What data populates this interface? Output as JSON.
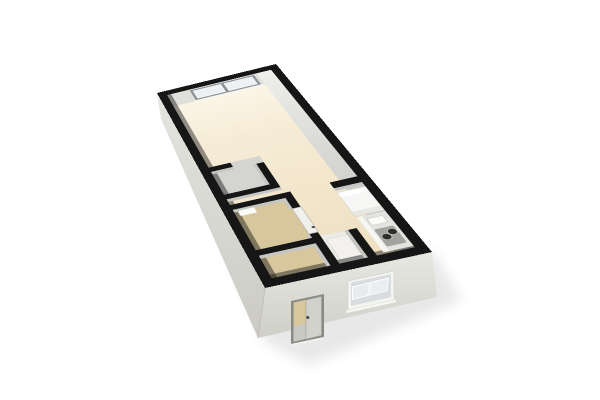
{
  "scene": {
    "type": "3d-floor-plan-render",
    "description": "Isometric 3D rendering of a narrow studio apartment floor plan on a white background, viewed from above at an angle",
    "rooms": [
      {
        "name": "living-area",
        "floor_finish": "cream"
      },
      {
        "name": "closet",
        "floor_finish": "gray"
      },
      {
        "name": "bathroom",
        "floor_finish": "tan"
      },
      {
        "name": "entry-hall",
        "floor_finish": "tan"
      },
      {
        "name": "storage-niche",
        "floor_finish": "white"
      },
      {
        "name": "kitchen-nook",
        "floor_finish": "cream"
      }
    ],
    "fixtures": [
      "double-pane-window-far-wall",
      "entry-door-near-wall",
      "tilted-sash-kitchen-window-near-wall",
      "bathroom-door",
      "bathroom-sink",
      "kitchen-partition-wall",
      "refrigerator",
      "kitchen-counter",
      "kitchen-sink",
      "cooktop"
    ],
    "cooktop_burner_count": 2,
    "far_window_pane_count": 2,
    "kitchen_window_sash_count": 2
  },
  "palette": {
    "background": "#ffffff",
    "wall_top": "#161616",
    "wall_interior_face": "#dfdfdc",
    "wall_interior_dark": "#c6c6c2",
    "exterior_sw_face": "#d9d9d3",
    "exterior_se_face": "#dedcd5",
    "floor_main": "#f2e4c8",
    "floor_entry": "#d8c69d",
    "floor_bath": "#d8c69c",
    "floor_closet": "#d4d4d0",
    "glass": "#e9edf0",
    "frame_gray": "#8f9499",
    "frame_white": "#f4f4f0",
    "door_white": "#f0f0ed",
    "door_frame": "#8a8a85",
    "door_panel": "#d2d2cd",
    "appliance_white": "#f7f7f5",
    "counter": "#e3e3df",
    "cooktop_panel": "#a3a39f",
    "burner": "#2d2d2b",
    "handle": "#454543"
  }
}
